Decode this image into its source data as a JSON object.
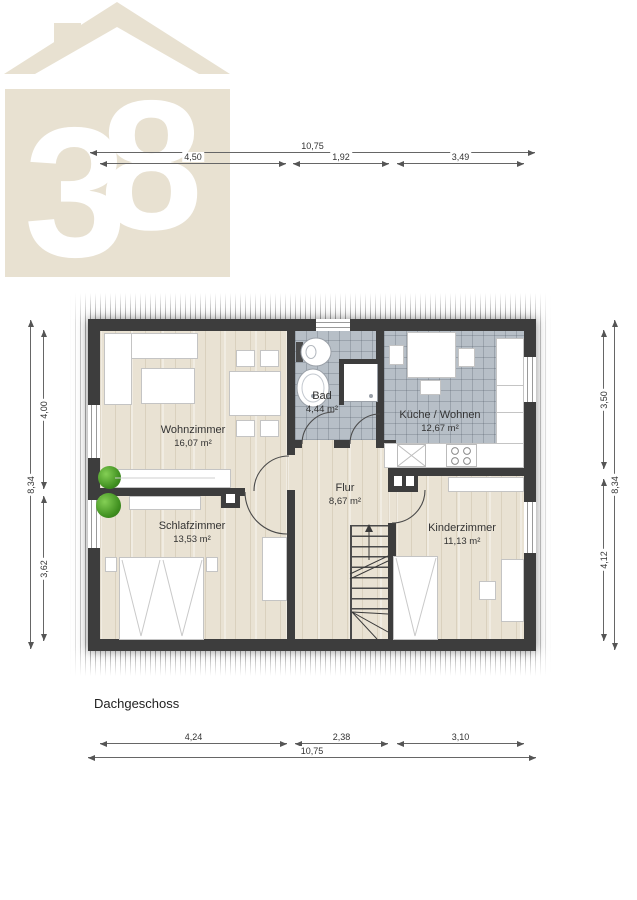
{
  "logo": {
    "digit1": "3",
    "digit2": "8",
    "beige": "#e8e1d1"
  },
  "plan": {
    "floor_label": "Dachgeschoss"
  },
  "rooms": [
    {
      "name": "Wohnzimmer",
      "area": "16,07 m²"
    },
    {
      "name": "Bad",
      "area": "4,44 m²"
    },
    {
      "name": "Küche / Wohnen",
      "area": "12,67 m²"
    },
    {
      "name": "Flur",
      "area": "8,67 m²"
    },
    {
      "name": "Schlafzimmer",
      "area": "13,53 m²"
    },
    {
      "name": "Kinderzimmer",
      "area": "11,13 m²"
    }
  ],
  "dimensions": {
    "top": {
      "total": "10,75",
      "seg1": "4,50",
      "seg2": "1,92",
      "seg3": "3,49"
    },
    "bottom": {
      "total": "10,75",
      "seg1": "4,24",
      "seg2": "2,38",
      "seg3": "3,10"
    },
    "left": {
      "total": "8,34",
      "seg1": "4,00",
      "seg2": "3,62"
    },
    "right": {
      "total": "8,34",
      "seg1": "3,50",
      "seg2": "4,12"
    }
  },
  "colors": {
    "wall": "#3d3d3d",
    "wood": "#e9e2d3",
    "tile": "#b7bfc7",
    "dimension_line": "#666666"
  }
}
